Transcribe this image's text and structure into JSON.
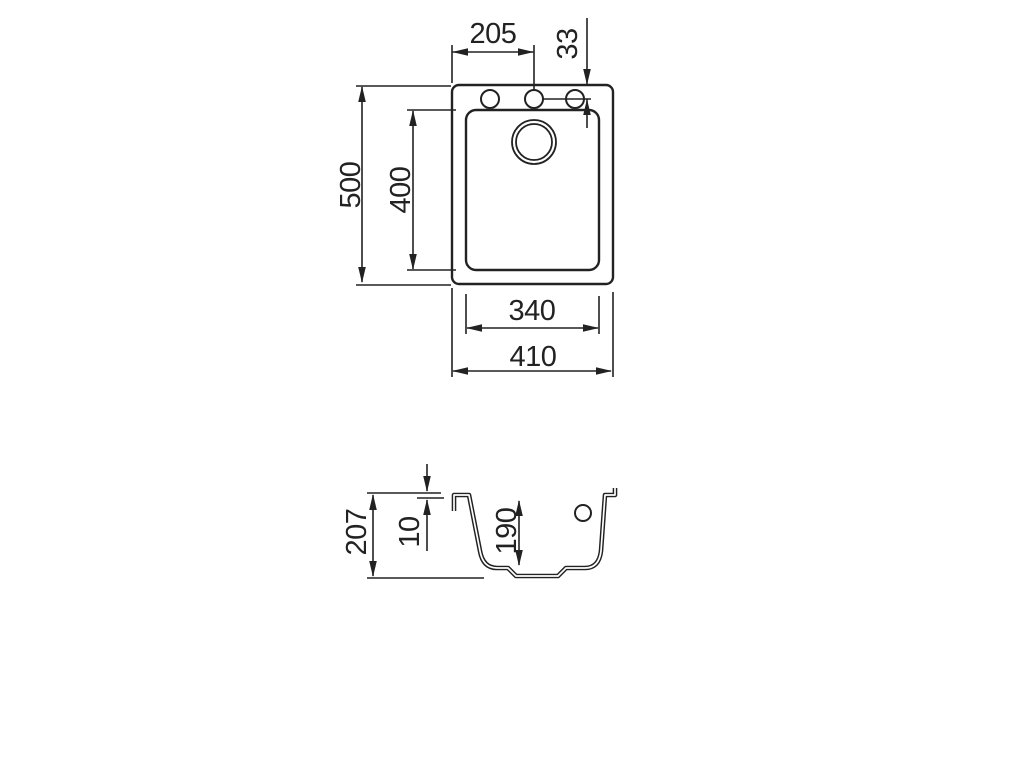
{
  "drawing": {
    "type": "sink-technical-drawing",
    "colors": {
      "line": "#222222",
      "background": "#ffffff"
    },
    "top_view": {
      "hole_offset_x": "205",
      "hole_offset_y": "33",
      "outer_height": "500",
      "inner_height": "400",
      "inner_width": "340",
      "outer_width": "410"
    },
    "section_view": {
      "total_height": "207",
      "rim_height": "10",
      "bowl_depth": "190"
    }
  }
}
